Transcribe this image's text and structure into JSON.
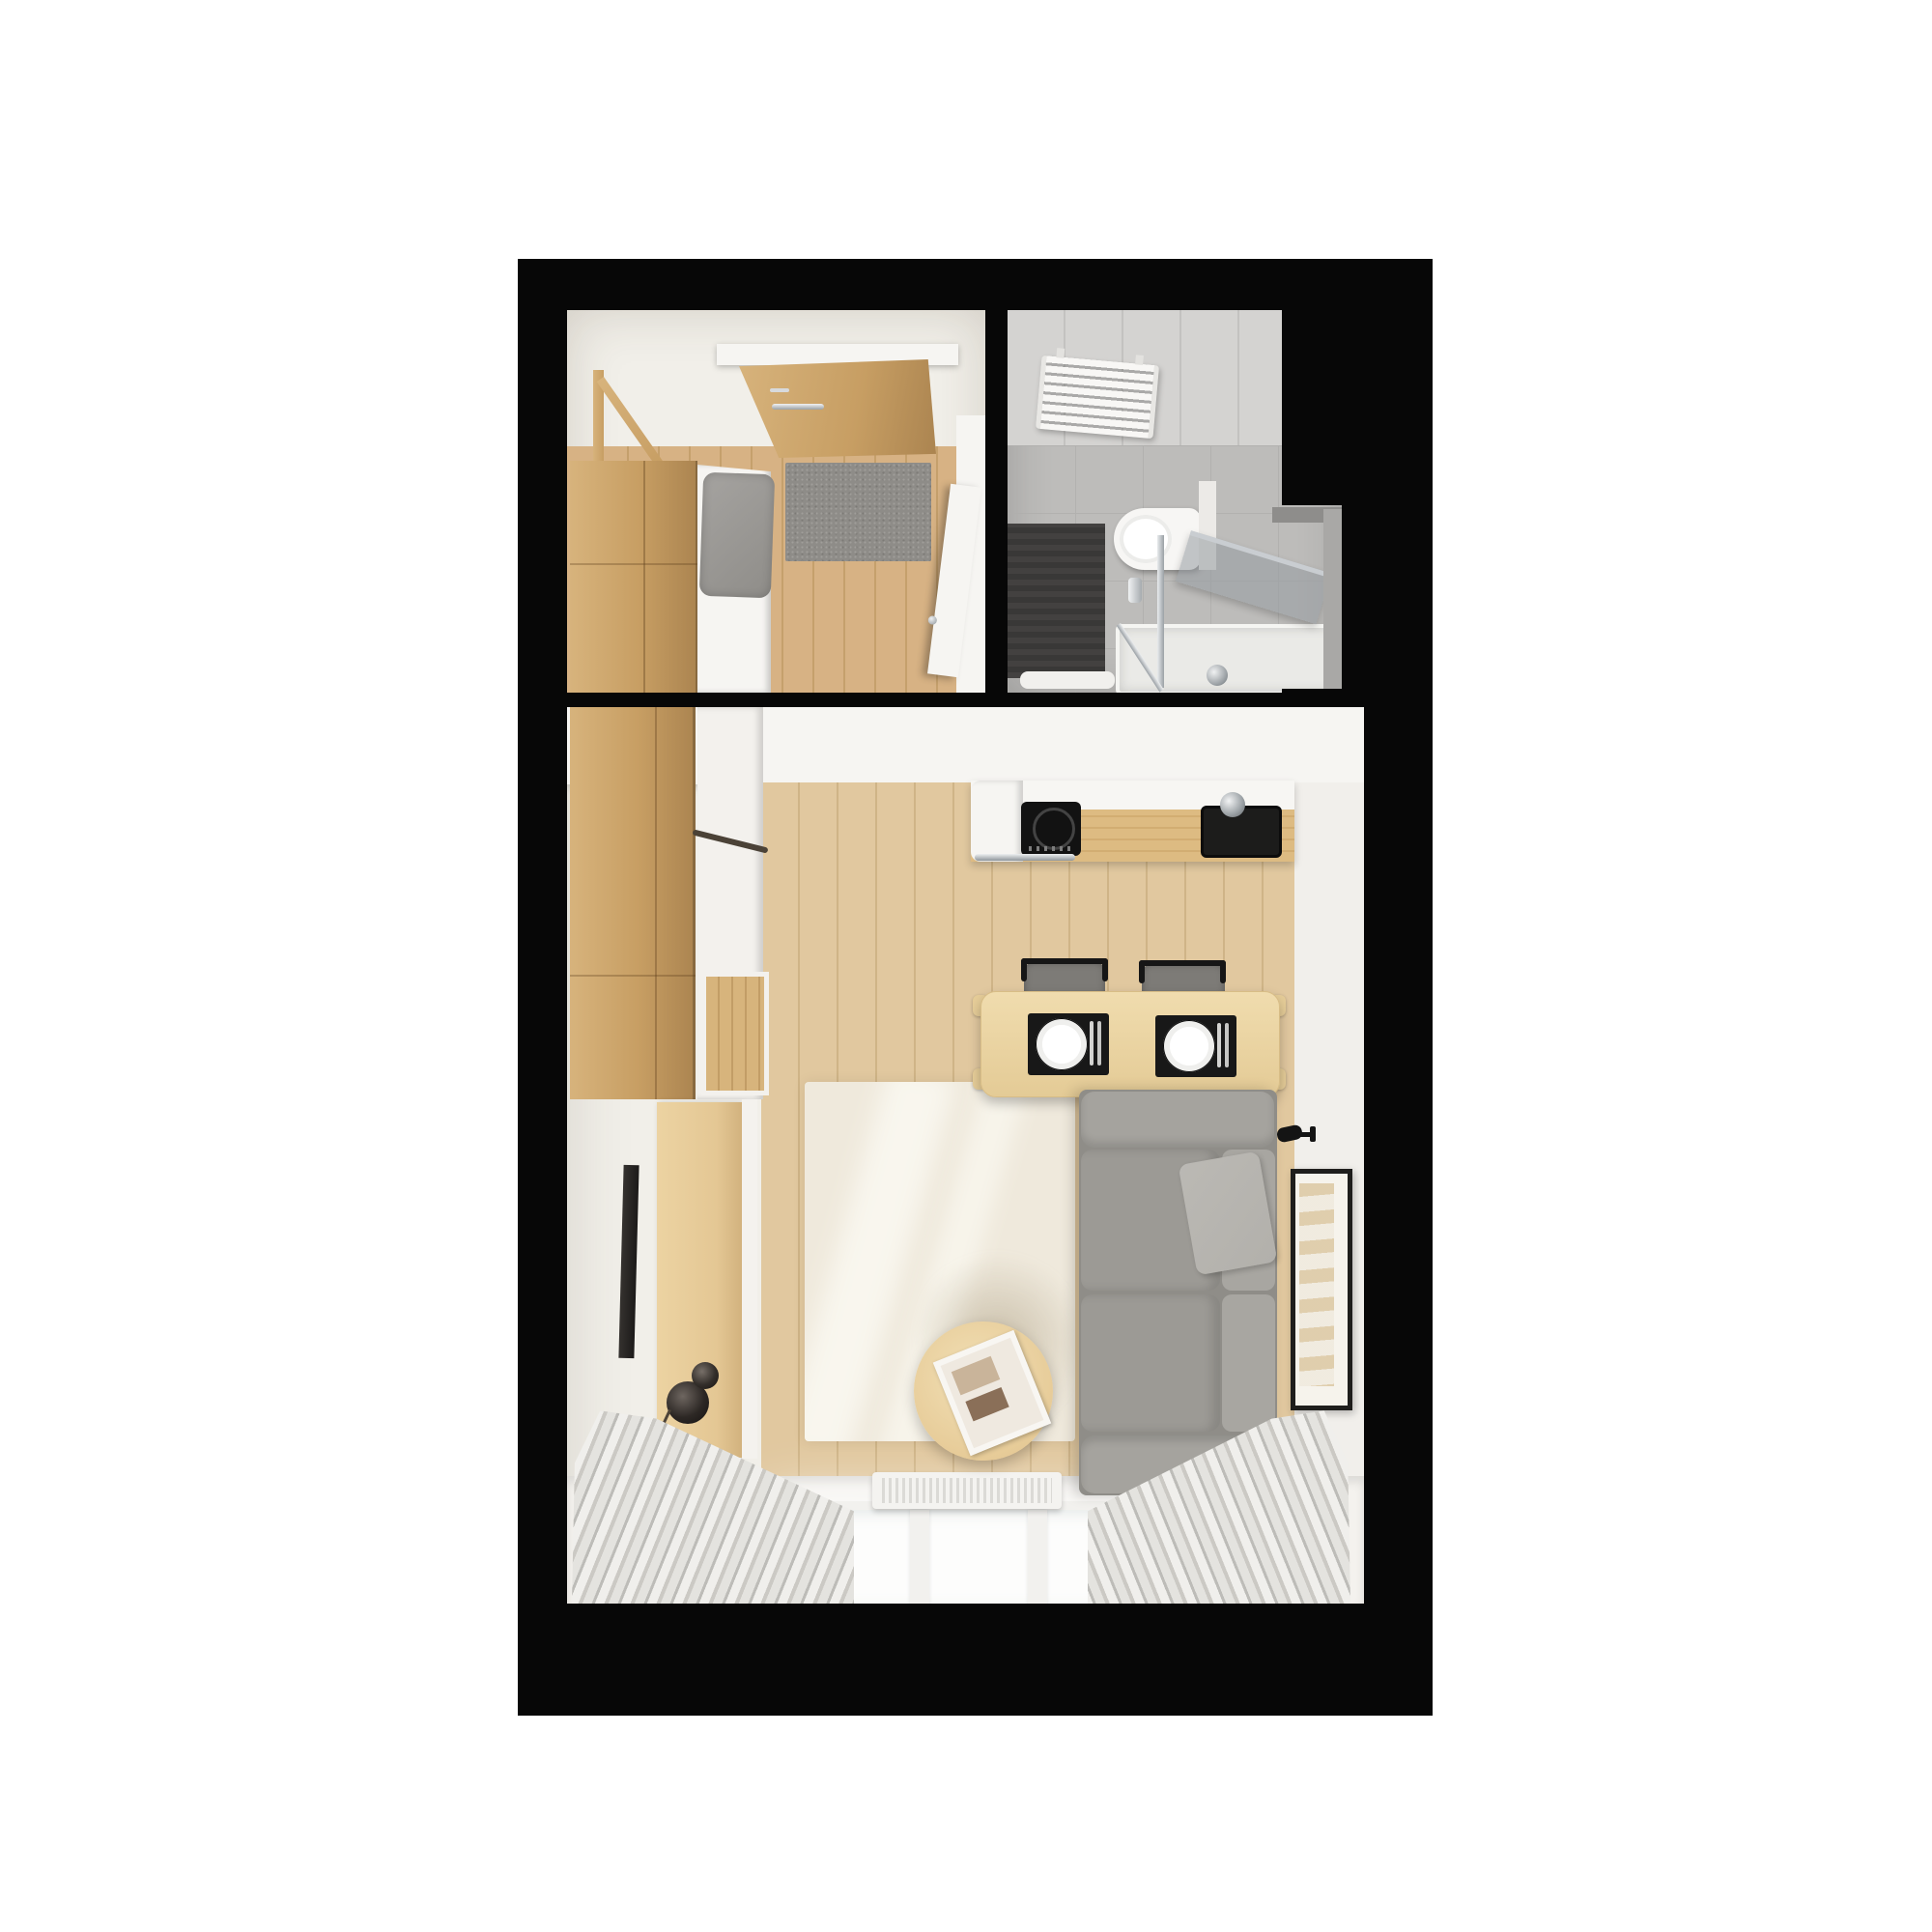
{
  "scene": {
    "type": "floor-plan-render",
    "view": "top-down",
    "subject": "studio-apartment",
    "text_content": "none"
  },
  "palette": {
    "bg": "#ffffff",
    "wall": "#070707",
    "room": "#f1efe9",
    "whiteFix": "#f6f5f2",
    "bathFloor": "#bdbcba",
    "bathWall": "#d4d3d1",
    "bathDark": "#3f3e3d",
    "oak": "#c79e63",
    "oakLight": "#d7b37c",
    "oakDark": "#ab8450",
    "floorHall": "#d7b284",
    "floorHallLine": "#c5a06c",
    "floorMain": "#e1c89f",
    "floorMainLine": "#cfb487",
    "counterWood": "#ddbb82",
    "benchWood": "#e4c794",
    "rug": "#efe9dc",
    "sofa": "#8f8d88",
    "sofaLight": "#a5a39e",
    "seat": "#9c9a95",
    "backCushion": "#a8a6a1",
    "pillow": "#b2b0ab",
    "chairSeat": "#7d7b77",
    "black": "#161616",
    "matGray": "#8e8c88",
    "chrome": "#ccd0d4",
    "glass": "rgba(150,155,160,0.55)",
    "curtainA": "#f0efec",
    "curtainB": "#cbc9c4",
    "curtainC": "#e4e3df"
  },
  "rooms": {
    "hallway": {
      "items": [
        "entry-door",
        "entry-door-handle",
        "door-mat",
        "wardrobe",
        "shoe-cabinet",
        "bench-cushion",
        "coat-rack",
        "bathroom-door-open"
      ]
    },
    "bathroom": {
      "items": [
        "towel-radiator",
        "toilet",
        "shower-mat",
        "bath-mat",
        "shower-glass-panel",
        "shower-glass-rail",
        "shower-tray",
        "shower-drain",
        "wall-ledge"
      ]
    },
    "living_kitchen": {
      "items": [
        "tall-wardrobe",
        "cabinet-column",
        "shelf-niche",
        "kitchen-counter",
        "induction-cooktop",
        "kitchen-sink",
        "faucet",
        "oven-handle",
        "bar-table",
        "placemats",
        "plates",
        "cutlery",
        "bar-chairs",
        "sofa",
        "sofa-pillow",
        "rug",
        "coffee-table",
        "serving-tray",
        "tv",
        "tv-bench",
        "decor-vases",
        "decor-branch",
        "wall-lamps",
        "picture-frame",
        "window",
        "window-radiator",
        "curtains"
      ]
    }
  }
}
